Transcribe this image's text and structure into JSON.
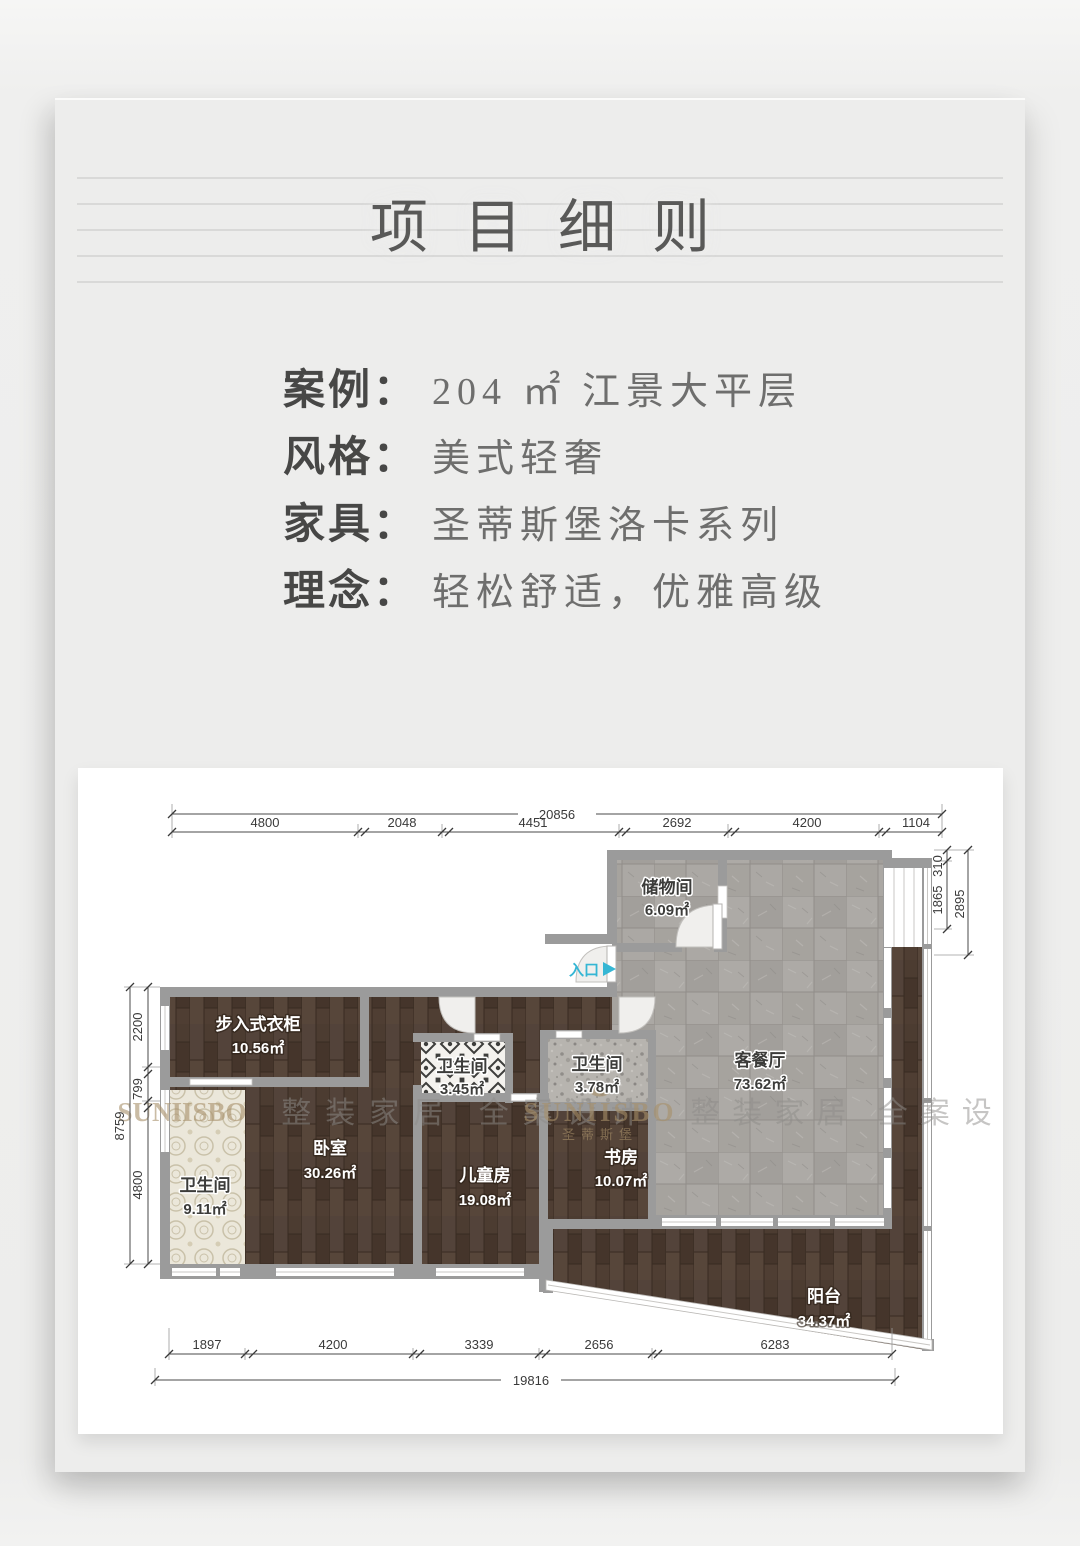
{
  "page": {
    "title": "项目细则"
  },
  "info": {
    "rows": [
      {
        "label": "案例：",
        "value": "204 ㎡ 江景大平层"
      },
      {
        "label": "风格：",
        "value": "美式轻奢"
      },
      {
        "label": "家具：",
        "value": "圣蒂斯堡洛卡系列"
      },
      {
        "label": "理念：",
        "value": "轻松舒适，优雅高级"
      }
    ]
  },
  "plan": {
    "entrance_label": "入口",
    "rooms": {
      "storage": {
        "name": "储物间",
        "area": "6.09㎡"
      },
      "living": {
        "name": "客餐厅",
        "area": "73.62㎡"
      },
      "closet": {
        "name": "步入式衣柜",
        "area": "10.56㎡"
      },
      "bath_small": {
        "name": "卫生间",
        "area": "3.45㎡"
      },
      "bath_mid": {
        "name": "卫生间",
        "area": "3.78㎡"
      },
      "bath_master": {
        "name": "卫生间",
        "area": "9.11㎡"
      },
      "bedroom": {
        "name": "卧室",
        "area": "30.26㎡"
      },
      "kids": {
        "name": "儿童房",
        "area": "19.08㎡"
      },
      "study": {
        "name": "书房",
        "area": "10.07㎡"
      },
      "balcony": {
        "name": "阳台",
        "area": "34.37㎡"
      }
    },
    "dims": {
      "top": {
        "total": "20856",
        "segments": [
          "4800",
          "2048",
          "4451",
          "2692",
          "4200",
          "1104"
        ]
      },
      "bottom": {
        "total": "19816",
        "segments": [
          "1897",
          "4200",
          "3339",
          "2656",
          "6283"
        ]
      },
      "left": {
        "total": "8759",
        "segments": [
          "2200",
          "799",
          "4800"
        ]
      },
      "right": {
        "segments": [
          "310",
          "1865",
          "2895"
        ]
      }
    },
    "watermark": {
      "brand": "SUNIISBO",
      "brand_cn": "圣蒂斯堡",
      "slogan": "整装家居 全案设计"
    }
  },
  "colors": {
    "entrance_accent": "#35b6d4",
    "wall_gray": "#9b9b9b",
    "wood_brown": "#4c3c31",
    "tile_gray": "#a8a5a1",
    "watermark_gold": "#a8906a",
    "card_bg": "#ededec"
  }
}
